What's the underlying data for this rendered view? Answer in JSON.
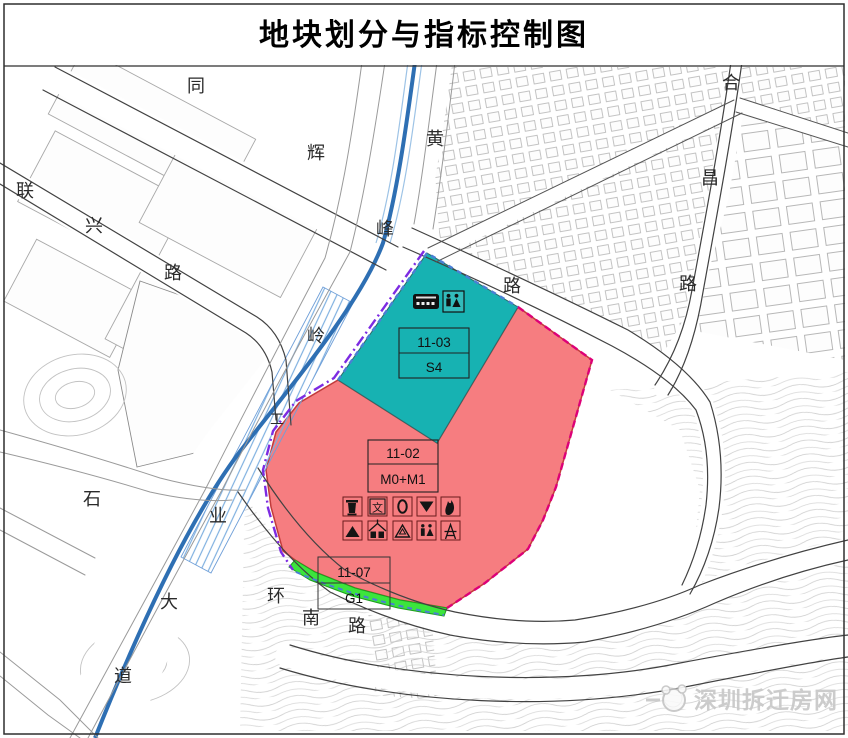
{
  "title": "地块划分与指标控制图",
  "watermark": "深圳拆迁房网",
  "colors": {
    "teal": "#17b2b2",
    "pink": "#f67d80",
    "green": "#3ce53c",
    "water_blue": "#2e6fb3",
    "boundary_purple": "#7d2be2",
    "boundary_magenta": "#dd0077",
    "edge_dash_blue": "#4a7fd4"
  },
  "map": {
    "parcels": [
      {
        "id": "11-03",
        "use": "S4"
      },
      {
        "id": "11-02",
        "use": "M0+M1"
      },
      {
        "id": "11-07",
        "use": "G1"
      }
    ],
    "icons": {
      "culture_char": "文"
    },
    "road_labels": [
      {
        "ch": "同",
        "x": 196,
        "y": 92
      },
      {
        "ch": "辉",
        "x": 316,
        "y": 159
      },
      {
        "ch": "路",
        "x": 512,
        "y": 292
      },
      {
        "ch": "黄",
        "x": 435,
        "y": 145
      },
      {
        "ch": "峰",
        "x": 385,
        "y": 235
      },
      {
        "ch": "岭",
        "x": 316,
        "y": 342
      },
      {
        "ch": "工",
        "x": 277,
        "y": 424
      },
      {
        "ch": "业",
        "x": 218,
        "y": 522
      },
      {
        "ch": "大",
        "x": 169,
        "y": 608
      },
      {
        "ch": "道",
        "x": 123,
        "y": 682
      },
      {
        "ch": "联",
        "x": 25,
        "y": 197
      },
      {
        "ch": "兴",
        "x": 94,
        "y": 232
      },
      {
        "ch": "路",
        "x": 173,
        "y": 279
      },
      {
        "ch": "合",
        "x": 731,
        "y": 89
      },
      {
        "ch": "昌",
        "x": 710,
        "y": 184
      },
      {
        "ch": "路",
        "x": 688,
        "y": 290
      },
      {
        "ch": "石",
        "x": 92,
        "y": 505
      },
      {
        "ch": "环",
        "x": 276,
        "y": 602
      },
      {
        "ch": "南",
        "x": 311,
        "y": 624
      },
      {
        "ch": "路",
        "x": 357,
        "y": 632
      }
    ]
  }
}
